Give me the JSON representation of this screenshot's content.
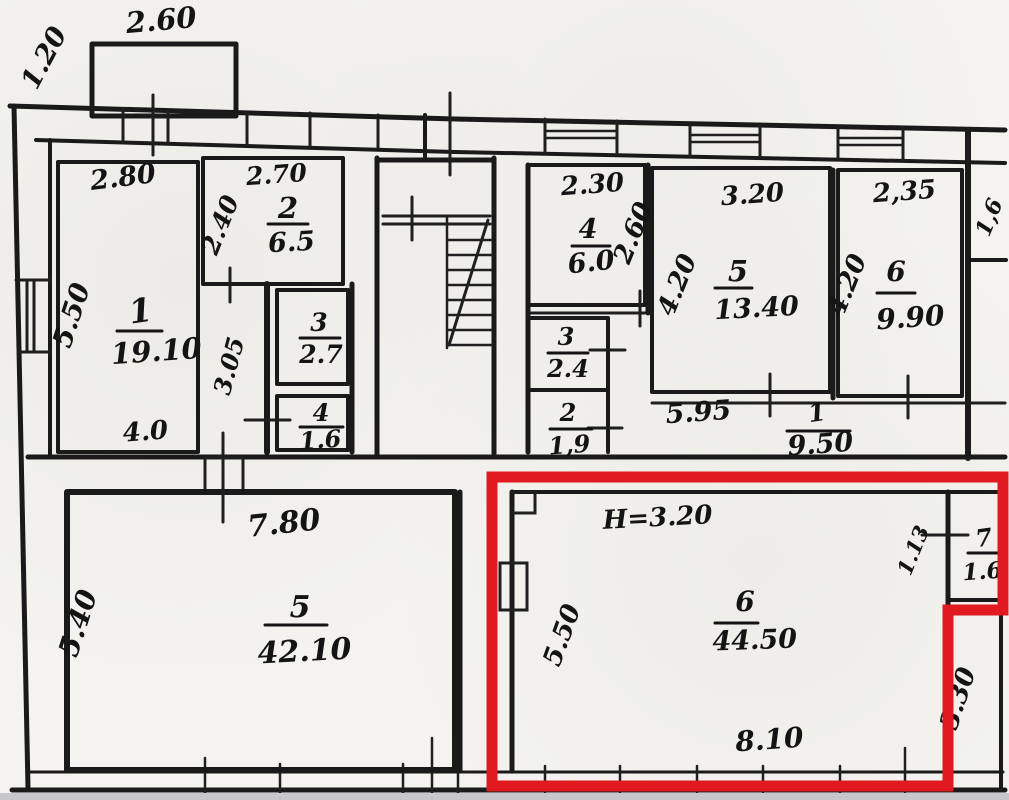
{
  "plan": {
    "title": "apartment-floor-plan-scan",
    "ink_color": "#1a1a1a",
    "paper_color": "#f4f3ef",
    "highlight_color": "#e01a20",
    "height_note": "H=3.20",
    "labels": [
      {
        "text": "1.20",
        "x": 52,
        "y": 62,
        "rot": -62,
        "size": 27
      },
      {
        "text": "2.60",
        "x": 162,
        "y": 30,
        "rot": -5,
        "size": 29
      },
      {
        "text": "2.80",
        "x": 124,
        "y": 186,
        "rot": -7,
        "size": 27
      },
      {
        "text": "2.70",
        "x": 277,
        "y": 183,
        "rot": -4,
        "size": 25
      },
      {
        "text": "2",
        "x": 288,
        "y": 218,
        "rot": 0,
        "size": 29
      },
      {
        "text": "6.5",
        "x": 292,
        "y": 251,
        "rot": -3,
        "size": 27
      },
      {
        "text": "2.40",
        "x": 228,
        "y": 228,
        "rot": -68,
        "size": 25
      },
      {
        "text": "1",
        "x": 142,
        "y": 322,
        "rot": -8,
        "size": 33
      },
      {
        "text": "19.10",
        "x": 157,
        "y": 361,
        "rot": -4,
        "size": 29
      },
      {
        "text": "5.50",
        "x": 80,
        "y": 318,
        "rot": -72,
        "size": 27
      },
      {
        "text": "4.0",
        "x": 146,
        "y": 440,
        "rot": -4,
        "size": 26
      },
      {
        "text": "3.05",
        "x": 237,
        "y": 368,
        "rot": -75,
        "size": 24
      },
      {
        "text": "3",
        "x": 319,
        "y": 331,
        "rot": 0,
        "size": 25
      },
      {
        "text": "2.7",
        "x": 321,
        "y": 363,
        "rot": 0,
        "size": 25
      },
      {
        "text": "4",
        "x": 321,
        "y": 421,
        "rot": 0,
        "size": 24
      },
      {
        "text": "1.6",
        "x": 321,
        "y": 448,
        "rot": -4,
        "size": 24
      },
      {
        "text": "2.30",
        "x": 593,
        "y": 193,
        "rot": -4,
        "size": 26
      },
      {
        "text": "4",
        "x": 588,
        "y": 238,
        "rot": 0,
        "size": 27
      },
      {
        "text": "6.0",
        "x": 592,
        "y": 271,
        "rot": -6,
        "size": 27
      },
      {
        "text": "2.60",
        "x": 641,
        "y": 236,
        "rot": -68,
        "size": 26
      },
      {
        "text": "3.20",
        "x": 753,
        "y": 203,
        "rot": -4,
        "size": 26
      },
      {
        "text": "5",
        "x": 738,
        "y": 281,
        "rot": 0,
        "size": 29
      },
      {
        "text": "13.40",
        "x": 757,
        "y": 317,
        "rot": -3,
        "size": 27
      },
      {
        "text": "4.20",
        "x": 685,
        "y": 288,
        "rot": -68,
        "size": 26
      },
      {
        "text": "2,35",
        "x": 905,
        "y": 200,
        "rot": -4,
        "size": 26
      },
      {
        "text": "6",
        "x": 896,
        "y": 281,
        "rot": 0,
        "size": 28
      },
      {
        "text": "9.90",
        "x": 911,
        "y": 327,
        "rot": -4,
        "size": 28
      },
      {
        "text": "4.20",
        "x": 855,
        "y": 288,
        "rot": -68,
        "size": 26
      },
      {
        "text": "1,6",
        "x": 996,
        "y": 220,
        "rot": -68,
        "size": 22
      },
      {
        "text": "3",
        "x": 566,
        "y": 345,
        "rot": 0,
        "size": 24
      },
      {
        "text": "2.4",
        "x": 568,
        "y": 377,
        "rot": 0,
        "size": 24
      },
      {
        "text": "2",
        "x": 568,
        "y": 421,
        "rot": 0,
        "size": 24
      },
      {
        "text": "1,9",
        "x": 570,
        "y": 453,
        "rot": -4,
        "size": 24
      },
      {
        "text": "5.95",
        "x": 699,
        "y": 421,
        "rot": -4,
        "size": 27
      },
      {
        "text": "1",
        "x": 818,
        "y": 421,
        "rot": -8,
        "size": 25
      },
      {
        "text": "9.50",
        "x": 821,
        "y": 453,
        "rot": -4,
        "size": 27
      },
      {
        "text": "7.80",
        "x": 285,
        "y": 533,
        "rot": -6,
        "size": 30
      },
      {
        "text": "5.40",
        "x": 87,
        "y": 626,
        "rot": -72,
        "size": 28
      },
      {
        "text": "5",
        "x": 300,
        "y": 617,
        "rot": 0,
        "size": 30
      },
      {
        "text": "42.10",
        "x": 305,
        "y": 661,
        "rot": -3,
        "size": 30
      },
      {
        "text": "H=3.20",
        "x": 658,
        "y": 526,
        "rot": -3,
        "size": 26
      },
      {
        "text": "5.50",
        "x": 570,
        "y": 638,
        "rot": -70,
        "size": 26
      },
      {
        "text": "6",
        "x": 745,
        "y": 611,
        "rot": 0,
        "size": 28
      },
      {
        "text": "44.50",
        "x": 755,
        "y": 649,
        "rot": -2,
        "size": 27
      },
      {
        "text": "8.10",
        "x": 770,
        "y": 749,
        "rot": -4,
        "size": 28
      },
      {
        "text": "1.13",
        "x": 920,
        "y": 553,
        "rot": -68,
        "size": 21
      },
      {
        "text": "7",
        "x": 985,
        "y": 546,
        "rot": -8,
        "size": 24
      },
      {
        "text": "1.6",
        "x": 983,
        "y": 579,
        "rot": -4,
        "size": 23
      },
      {
        "text": "3.30",
        "x": 966,
        "y": 701,
        "rot": -72,
        "size": 26
      }
    ]
  }
}
